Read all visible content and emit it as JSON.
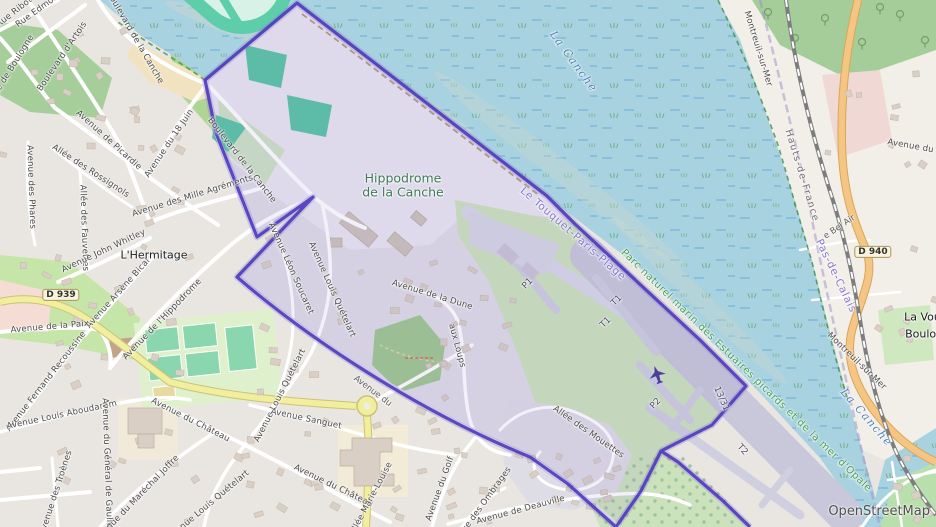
{
  "map": {
    "attribution": "OpenStreetMap",
    "colors": {
      "boundary": "#4F3DBB",
      "boundary_glow": "#8C7BD8",
      "commune_tint": "rgba(124,110,200,0.10)",
      "water": "#A8D2E0",
      "track_teal": "#5ECDAA",
      "aerodrome_grass": "#CCE2BC",
      "runway_gray": "#C8C8DA",
      "road_primary_orange": "#F5C583",
      "road_secondary_yellow": "#F1EE9E",
      "forest_green": "#A5CD99",
      "nature_label_green": "#4A9E52"
    },
    "labels": [
      {
        "kind": "street",
        "text": "Rue Ribot",
        "x": 15,
        "y": 13,
        "rot": -38
      },
      {
        "kind": "street",
        "text": "Rue Edmond",
        "x": 40,
        "y": 10,
        "rot": -36
      },
      {
        "kind": "street",
        "text": "Rue de Boulogne",
        "x": 13,
        "y": 68,
        "rot": -58
      },
      {
        "kind": "street",
        "text": "Boulevard d'Artois",
        "x": 63,
        "y": 57,
        "rot": -56
      },
      {
        "kind": "street",
        "text": "Boulevard de la Canche",
        "x": 134,
        "y": 38,
        "rot": 60
      },
      {
        "kind": "street",
        "text": "Boulevard de la Canche",
        "x": 241,
        "y": 161,
        "rot": 52
      },
      {
        "kind": "street",
        "text": "Avenue de Picardie",
        "x": 108,
        "y": 141,
        "rot": 42
      },
      {
        "kind": "street",
        "text": "Avenue du 18 Juin",
        "x": 170,
        "y": 144,
        "rot": -56
      },
      {
        "kind": "street",
        "text": "Avenue des Phares",
        "x": 30,
        "y": 187,
        "rot": 88
      },
      {
        "kind": "street",
        "text": "Allée des Rossignols",
        "x": 90,
        "y": 172,
        "rot": 33
      },
      {
        "kind": "street",
        "text": "Allée des Fauvettes",
        "x": 83,
        "y": 228,
        "rot": 88
      },
      {
        "kind": "street",
        "text": "Avenue John Whitley",
        "x": 104,
        "y": 252,
        "rot": -25
      },
      {
        "kind": "street",
        "text": "Avenue Arsène Bical",
        "x": 119,
        "y": 294,
        "rot": -48
      },
      {
        "kind": "street",
        "text": "Avenue des Mille Agréments",
        "x": 193,
        "y": 197,
        "rot": -17
      },
      {
        "kind": "street",
        "text": "Avenue de l'Hippodrome",
        "x": 163,
        "y": 320,
        "rot": -46
      },
      {
        "kind": "street",
        "text": "Avenue de la Paix",
        "x": 50,
        "y": 328,
        "rot": -5
      },
      {
        "kind": "street",
        "text": "Avenue Fernand Recoussine",
        "x": 47,
        "y": 382,
        "rot": -52
      },
      {
        "kind": "street",
        "text": "Avenue Louis Aboudaram",
        "x": 62,
        "y": 416,
        "rot": -12
      },
      {
        "kind": "street",
        "text": "Avenue du Général de Gaulle",
        "x": 106,
        "y": 463,
        "rot": 88
      },
      {
        "kind": "street",
        "text": "Avenue du Château",
        "x": 190,
        "y": 421,
        "rot": 27
      },
      {
        "kind": "street",
        "text": "Avenue du Château",
        "x": 333,
        "y": 487,
        "rot": 26
      },
      {
        "kind": "street",
        "text": "Avenue des Troènes",
        "x": 57,
        "y": 493,
        "rot": -72
      },
      {
        "kind": "street",
        "text": "Avenue du Maréchal Joffre",
        "x": 138,
        "y": 499,
        "rot": -46
      },
      {
        "kind": "street",
        "text": "Avenue Louis Quételart",
        "x": 331,
        "y": 290,
        "rot": 66
      },
      {
        "kind": "street",
        "text": "Avenue Louis Quételart",
        "x": 281,
        "y": 396,
        "rot": -63
      },
      {
        "kind": "street",
        "text": "Avenue Louis Quételart",
        "x": 209,
        "y": 506,
        "rot": -40
      },
      {
        "kind": "street",
        "text": "Avenue Léon Soucaret",
        "x": 290,
        "y": 269,
        "rot": 66
      },
      {
        "kind": "street",
        "text": "Avenue Sanguet",
        "x": 306,
        "y": 420,
        "rot": 12
      },
      {
        "kind": "street",
        "text": "Allée Marie-Louise",
        "x": 372,
        "y": 499,
        "rot": -62
      },
      {
        "kind": "street",
        "text": "Avenue du Golf",
        "x": 441,
        "y": 489,
        "rot": -70
      },
      {
        "kind": "street",
        "text": "Avenue des Ombrages",
        "x": 481,
        "y": 509,
        "rot": -54
      },
      {
        "kind": "street",
        "text": "Avenue de Deauville",
        "x": 521,
        "y": 511,
        "rot": -15
      },
      {
        "kind": "street",
        "text": "Allée des Mouettes",
        "x": 588,
        "y": 433,
        "rot": 35
      },
      {
        "kind": "street",
        "text": "Avenue de la Dune",
        "x": 432,
        "y": 296,
        "rot": 17
      },
      {
        "kind": "street",
        "text": "aux Loups",
        "x": 456,
        "y": 346,
        "rot": 75
      },
      {
        "kind": "fragment",
        "text": "Avenue du",
        "x": 372,
        "y": 392,
        "rot": 37
      },
      {
        "kind": "street",
        "text": "Avenue du Bois",
        "x": 921,
        "y": 149,
        "rot": 10
      },
      {
        "kind": "fragment",
        "text": "e Bel Air",
        "x": 840,
        "y": 228,
        "rot": -34
      },
      {
        "kind": "street",
        "text": "Montreuil-sur-Mer",
        "x": 757,
        "y": 49,
        "rot": 73
      },
      {
        "kind": "street",
        "text": "Montreuil-sur-Mer",
        "x": 856,
        "y": 362,
        "rot": 44
      },
      {
        "kind": "place",
        "text": "L'Hermitage",
        "x": 154,
        "y": 256,
        "rot": 0
      },
      {
        "kind": "place",
        "text": "La Voute",
        "x": 928,
        "y": 318,
        "rot": 0
      },
      {
        "kind": "place",
        "text": "Boulogne",
        "x": 931,
        "y": 335,
        "rot": 0
      },
      {
        "kind": "boundarylbl",
        "text": "Le Touquet-Paris-Plage",
        "x": 573,
        "y": 234,
        "rot": 41
      },
      {
        "kind": "boundarylbl",
        "text": "Pas-de-Calais",
        "x": 836,
        "y": 276,
        "rot": 64
      },
      {
        "kind": "region",
        "text": "Hauts-de-France",
        "x": 801,
        "y": 176,
        "rot": 73
      },
      {
        "kind": "nature",
        "text": "Parc naturel marin des Estuaires picards et de la mer d'Opale",
        "x": 746,
        "y": 371,
        "rot": 44
      },
      {
        "kind": "leisure",
        "text": "Hippodrome\nde la Canche",
        "x": 403,
        "y": 186,
        "rot": 0
      },
      {
        "kind": "waterlbl",
        "text": "La Canche",
        "x": 573,
        "y": 62,
        "rot": 54
      },
      {
        "kind": "waterlbl",
        "text": "La Canche",
        "x": 866,
        "y": 418,
        "rot": 49
      },
      {
        "kind": "airport",
        "text": "P1",
        "x": 528,
        "y": 284,
        "rot": -45
      },
      {
        "kind": "airport",
        "text": "T1",
        "x": 617,
        "y": 301,
        "rot": -45
      },
      {
        "kind": "airport",
        "text": "T1",
        "x": 606,
        "y": 323,
        "rot": -45
      },
      {
        "kind": "airport",
        "text": "P2",
        "x": 656,
        "y": 404,
        "rot": -45
      },
      {
        "kind": "airport",
        "text": "13/31",
        "x": 721,
        "y": 399,
        "rot": 66
      },
      {
        "kind": "airport",
        "text": "T2",
        "x": 742,
        "y": 450,
        "rot": 48
      },
      {
        "kind": "shield",
        "text": "D 939",
        "x": 61,
        "y": 295,
        "rot": 0
      },
      {
        "kind": "shield",
        "text": "D 940",
        "x": 873,
        "y": 252,
        "rot": 0
      }
    ]
  }
}
